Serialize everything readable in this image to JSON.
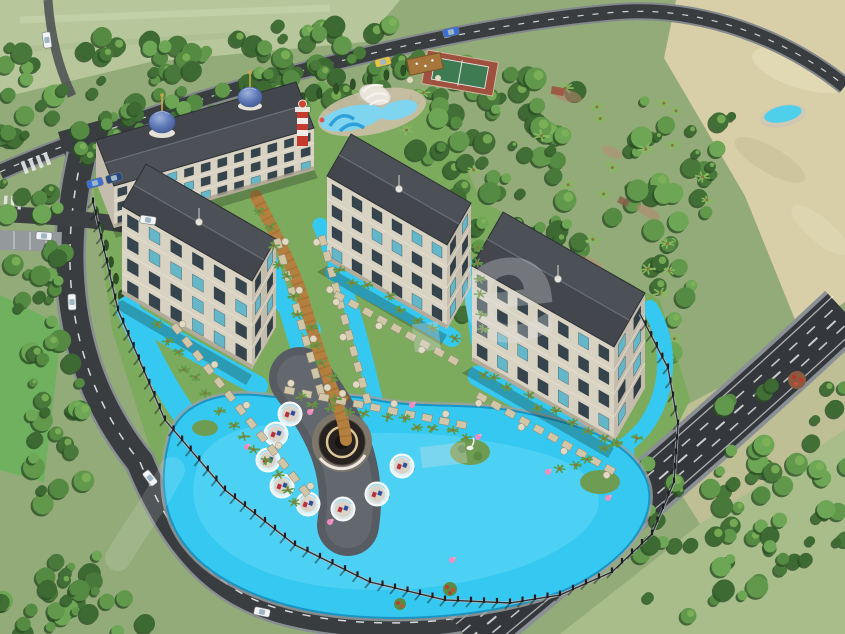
{
  "meta": {
    "title": "Aerial 3D architectural rendering of a resort-style residential complex with lagoon pool",
    "width_px": 845,
    "height_px": 634
  },
  "watermark": {
    "text": ".e -",
    "color": "#e4e4e4"
  },
  "scene": {
    "counts": {
      "buildings": 4,
      "roof_domes": 2,
      "pool_cabanas": 8,
      "flamingo_floats": 8,
      "water_slides": 3,
      "tennis_courts": 1,
      "lighthouses": 1,
      "cars_visible": 10,
      "lagoon_islands": 3
    },
    "colors": {
      "lagoon_pool": "#35c8f0",
      "pool_light": "#5fd7f7",
      "roof": "#43474d",
      "facade": "#d8d2c3",
      "dome_blue": "#5d77b4",
      "spire_gold": "#c9a84c",
      "lawn_green": "#7cab5e",
      "forest_green": "#4d7c3c",
      "sand": "#d8cfa8",
      "road_asphalt": "#3a3d40",
      "boardwalk_wood": "#b5803f",
      "lighthouse_red": "#c43a2c",
      "pool_deck": "#575c62",
      "canopy_tan": "#d2c6a8"
    }
  }
}
